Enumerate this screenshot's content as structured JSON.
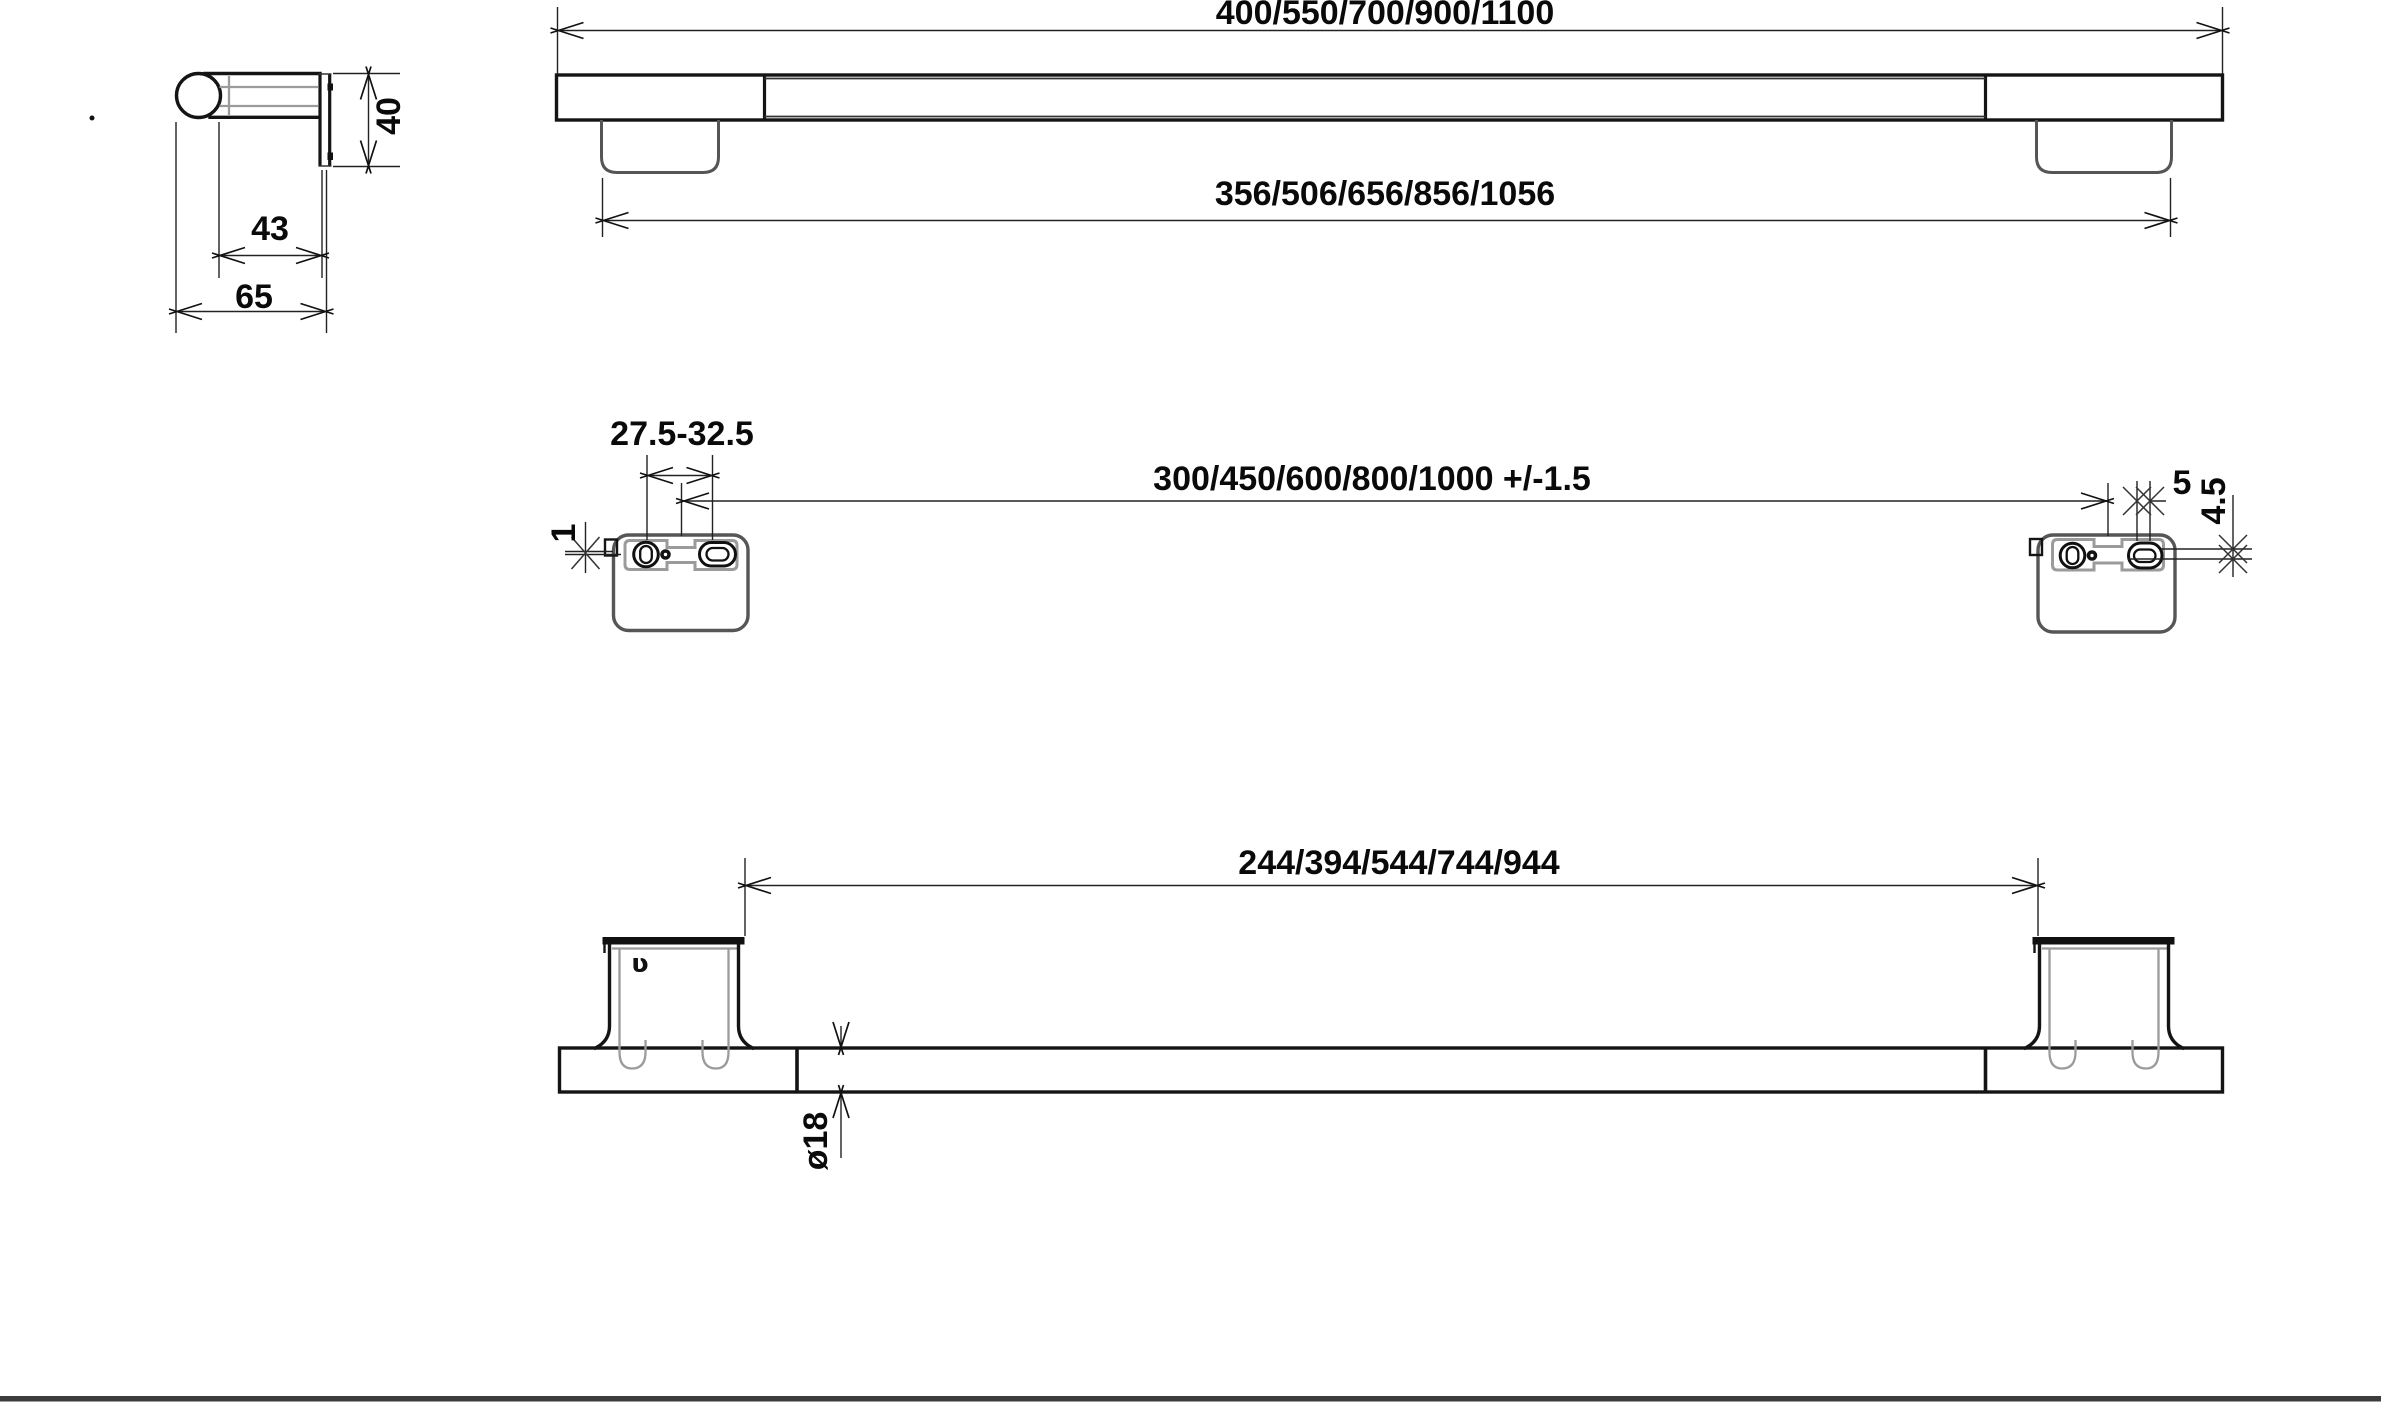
{
  "dims": {
    "front_overall": "400/550/700/900/1100",
    "front_body": "356/506/656/856/1056",
    "side_height": "40",
    "side_depth": "43",
    "side_total_depth": "65",
    "plate_adjust_range": "27.5-32.5",
    "plate_centers": "300/450/600/800/1000 +/-1.5",
    "plate_clip_offset": "1",
    "plate_slot_width": "5",
    "plate_slot_height": "4.5",
    "bottom_span": "244/394/544/744/944",
    "bar_diameter": "ø18",
    "clip_mark": "ʋ"
  }
}
